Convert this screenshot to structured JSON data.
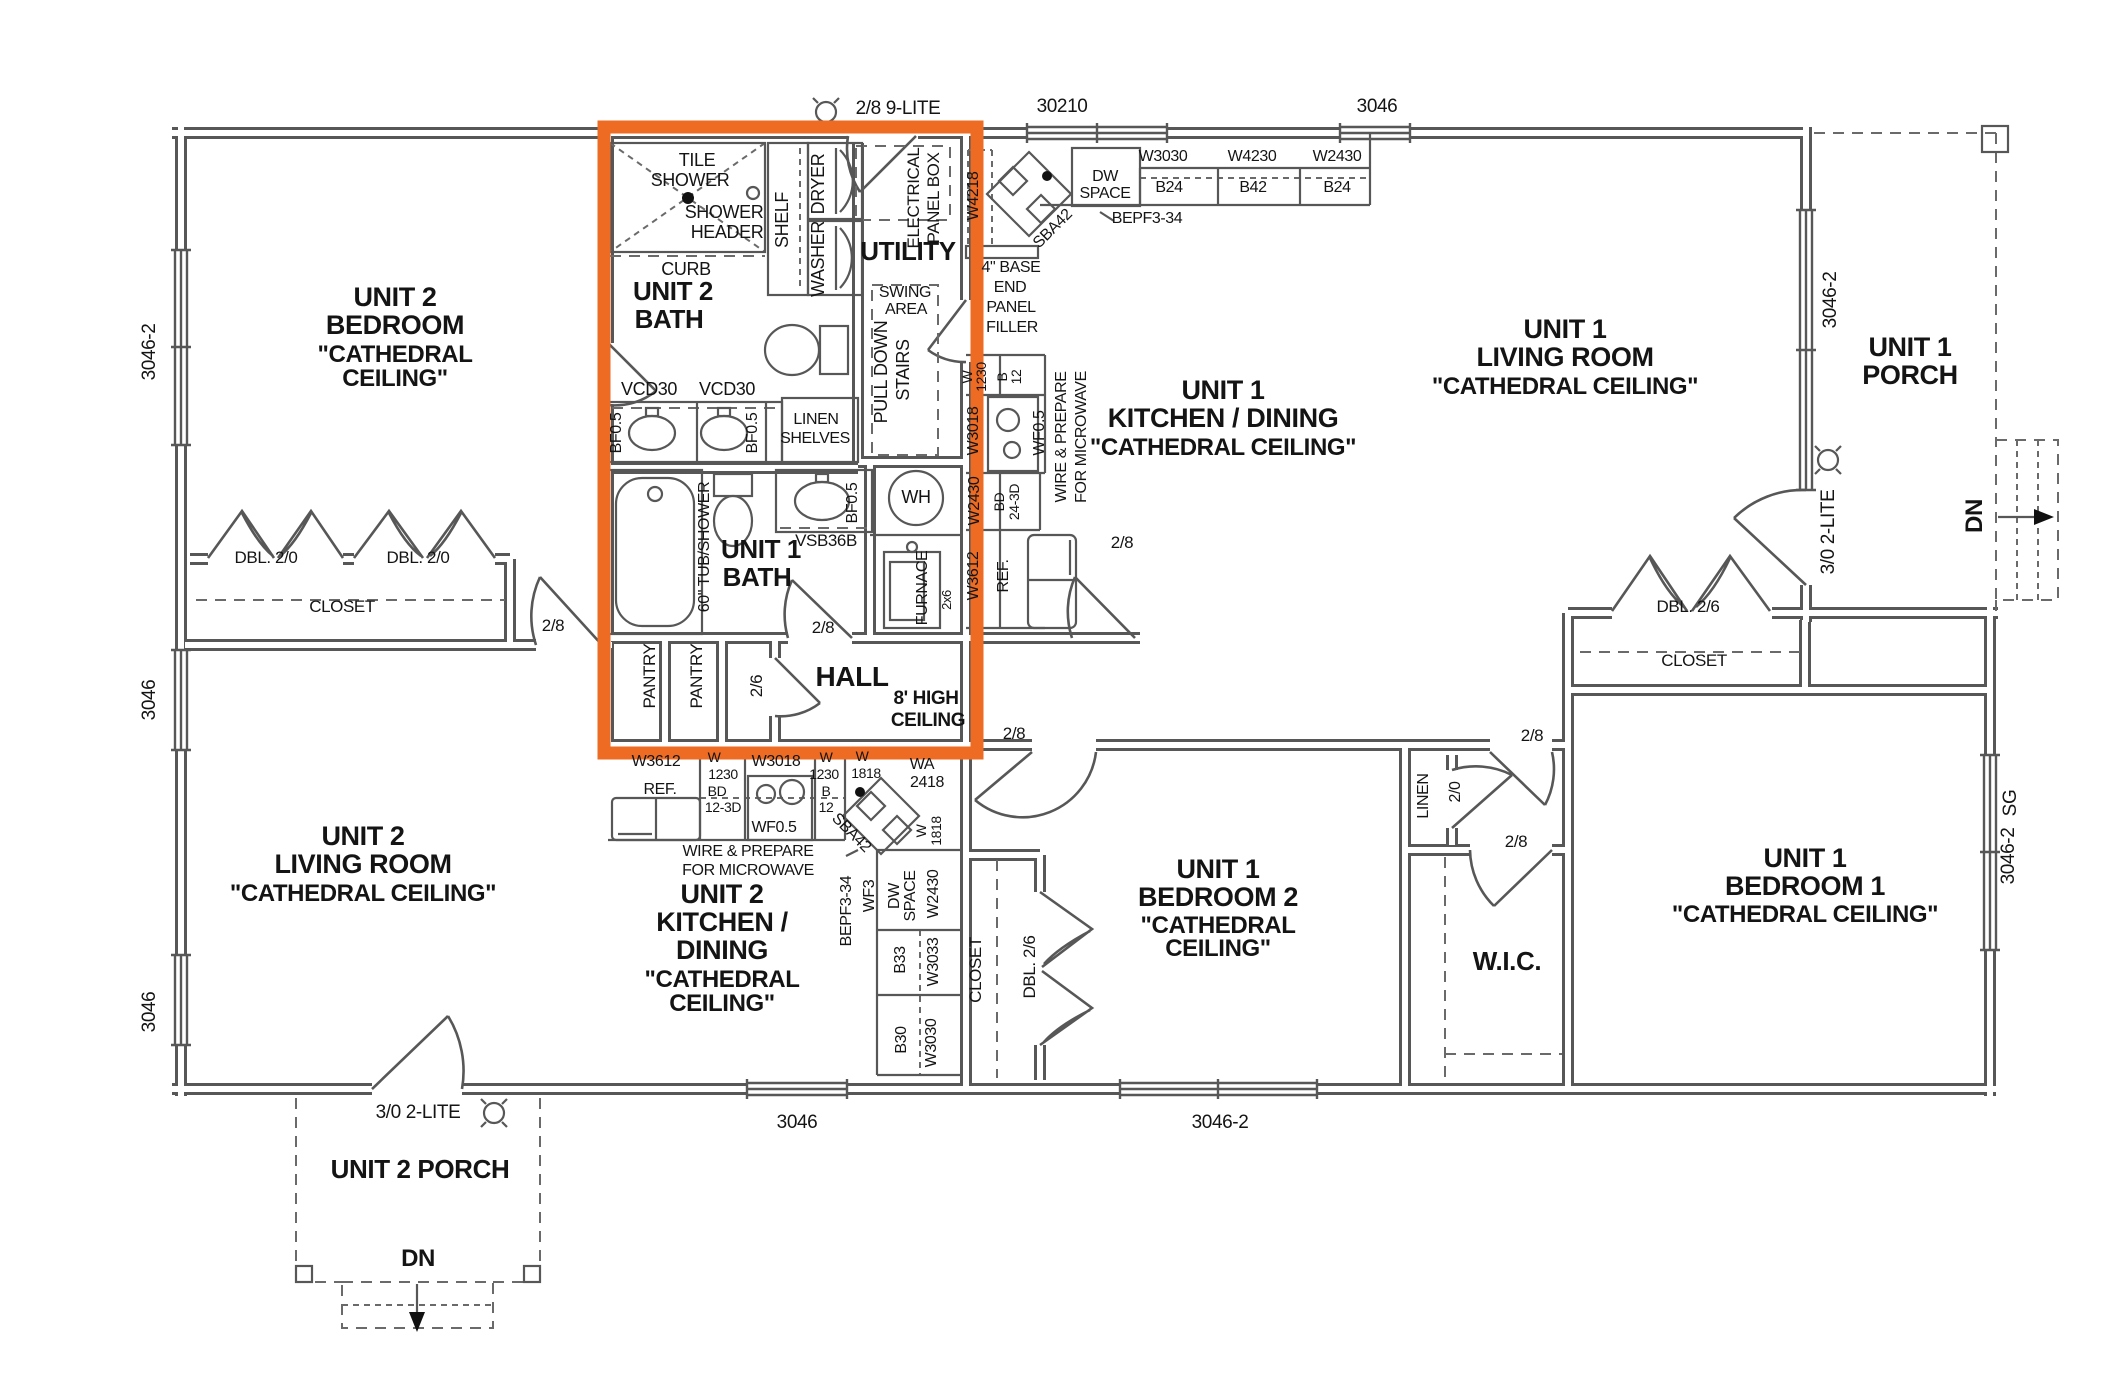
{
  "title": "Duplex floor plan",
  "colors": {
    "highlight_box": "#ee6b23",
    "wall": "#575757",
    "text": "#141414",
    "background": "#ffffff"
  },
  "highlight_region": {
    "label": "baths-utility-hall-core",
    "x": 604,
    "y": 127,
    "width": 373,
    "height": 626
  },
  "labels": [
    {
      "id": "dim-top-door",
      "text": "2/8 9-LITE",
      "x": 898,
      "y": 114,
      "s": 19
    },
    {
      "id": "dim-win-30210",
      "text": "30210",
      "x": 1062,
      "y": 112,
      "s": 19
    },
    {
      "id": "dim-win-top-3046",
      "text": "3046",
      "x": 1377,
      "y": 112,
      "s": 19
    },
    {
      "id": "dim-left-3046-2",
      "text": "3046-2",
      "x": 155,
      "y": 352,
      "s": 19,
      "r": -90
    },
    {
      "id": "dim-left-3046-a",
      "text": "3046",
      "x": 155,
      "y": 700,
      "s": 19,
      "r": -90
    },
    {
      "id": "dim-left-3046-b",
      "text": "3046",
      "x": 155,
      "y": 1012,
      "s": 19,
      "r": -90
    },
    {
      "id": "dim-bottom-3046",
      "text": "3046",
      "x": 797,
      "y": 1128,
      "s": 19
    },
    {
      "id": "dim-bottom-3046-2",
      "text": "3046-2",
      "x": 1220,
      "y": 1128,
      "s": 19
    },
    {
      "id": "dim-door-porch2",
      "text": "3/0 2-LITE",
      "x": 418,
      "y": 1118,
      "s": 19
    },
    {
      "id": "dim-door-porch1",
      "text": "3/0 2-LITE",
      "x": 1834,
      "y": 532,
      "s": 19,
      "r": -90
    },
    {
      "id": "dim-win-lr1",
      "text": "3046-2",
      "x": 1836,
      "y": 300,
      "s": 19,
      "r": -90
    },
    {
      "id": "dim-win-sg",
      "text": "SG",
      "x": 2016,
      "y": 803,
      "s": 19,
      "r": -90
    },
    {
      "id": "dim-win-right",
      "text": "3046-2",
      "x": 2014,
      "y": 856,
      "s": 19,
      "r": -90
    },
    {
      "id": "u2bed-1",
      "text": "UNIT 2",
      "x": 395,
      "y": 306,
      "s": 27,
      "b": 1
    },
    {
      "id": "u2bed-2",
      "text": "BEDROOM",
      "x": 395,
      "y": 334,
      "s": 27,
      "b": 1
    },
    {
      "id": "u2bed-3",
      "text": "\"CATHEDRAL",
      "x": 395,
      "y": 362,
      "s": 24,
      "b": 1
    },
    {
      "id": "u2bed-4",
      "text": "CEILING\"",
      "x": 395,
      "y": 386,
      "s": 24,
      "b": 1
    },
    {
      "id": "u2liv-1",
      "text": "UNIT 2",
      "x": 363,
      "y": 845,
      "s": 27,
      "b": 1
    },
    {
      "id": "u2liv-2",
      "text": "LIVING ROOM",
      "x": 363,
      "y": 873,
      "s": 27,
      "b": 1
    },
    {
      "id": "u2liv-3",
      "text": "\"CATHEDRAL CEILING\"",
      "x": 363,
      "y": 901,
      "s": 24,
      "b": 1
    },
    {
      "id": "u2kit-1",
      "text": "UNIT 2",
      "x": 722,
      "y": 903,
      "s": 27,
      "b": 1
    },
    {
      "id": "u2kit-2",
      "text": "KITCHEN /",
      "x": 722,
      "y": 931,
      "s": 27,
      "b": 1
    },
    {
      "id": "u2kit-3",
      "text": "DINING",
      "x": 722,
      "y": 959,
      "s": 27,
      "b": 1
    },
    {
      "id": "u2kit-4",
      "text": "\"CATHEDRAL",
      "x": 722,
      "y": 987,
      "s": 24,
      "b": 1
    },
    {
      "id": "u2kit-5",
      "text": "CEILING\"",
      "x": 722,
      "y": 1011,
      "s": 24,
      "b": 1
    },
    {
      "id": "u2porch",
      "text": "UNIT 2 PORCH",
      "x": 420,
      "y": 1178,
      "s": 26,
      "b": 1
    },
    {
      "id": "u1kit-1",
      "text": "UNIT 1",
      "x": 1223,
      "y": 399,
      "s": 27,
      "b": 1
    },
    {
      "id": "u1kit-2",
      "text": "KITCHEN / DINING",
      "x": 1223,
      "y": 427,
      "s": 27,
      "b": 1
    },
    {
      "id": "u1kit-3",
      "text": "\"CATHEDRAL CEILING\"",
      "x": 1223,
      "y": 455,
      "s": 24,
      "b": 1
    },
    {
      "id": "u1liv-1",
      "text": "UNIT 1",
      "x": 1565,
      "y": 338,
      "s": 27,
      "b": 1
    },
    {
      "id": "u1liv-2",
      "text": "LIVING ROOM",
      "x": 1565,
      "y": 366,
      "s": 27,
      "b": 1
    },
    {
      "id": "u1liv-3",
      "text": "\"CATHEDRAL CEILING\"",
      "x": 1565,
      "y": 394,
      "s": 24,
      "b": 1
    },
    {
      "id": "u1porch-1",
      "text": "UNIT 1",
      "x": 1910,
      "y": 356,
      "s": 27,
      "b": 1
    },
    {
      "id": "u1porch-2",
      "text": "PORCH",
      "x": 1910,
      "y": 384,
      "s": 27,
      "b": 1
    },
    {
      "id": "u1bed2-1",
      "text": "UNIT 1",
      "x": 1218,
      "y": 878,
      "s": 27,
      "b": 1
    },
    {
      "id": "u1bed2-2",
      "text": "BEDROOM 2",
      "x": 1218,
      "y": 906,
      "s": 27,
      "b": 1
    },
    {
      "id": "u1bed2-3",
      "text": "\"CATHEDRAL",
      "x": 1218,
      "y": 933,
      "s": 24,
      "b": 1
    },
    {
      "id": "u1bed2-4",
      "text": "CEILING\"",
      "x": 1218,
      "y": 956,
      "s": 24,
      "b": 1
    },
    {
      "id": "u1bed1-1",
      "text": "UNIT 1",
      "x": 1805,
      "y": 867,
      "s": 27,
      "b": 1
    },
    {
      "id": "u1bed1-2",
      "text": "BEDROOM 1",
      "x": 1805,
      "y": 895,
      "s": 27,
      "b": 1
    },
    {
      "id": "u1bed1-3",
      "text": "\"CATHEDRAL CEILING\"",
      "x": 1805,
      "y": 922,
      "s": 24,
      "b": 1
    },
    {
      "id": "wic",
      "text": "W.I.C.",
      "x": 1507,
      "y": 970,
      "s": 26,
      "b": 1
    },
    {
      "id": "utility",
      "text": "UTILITY",
      "x": 908,
      "y": 260,
      "s": 26,
      "b": 1
    },
    {
      "id": "u2bath-1",
      "text": "UNIT 2",
      "x": 673,
      "y": 300,
      "s": 26,
      "b": 1
    },
    {
      "id": "u2bath-2",
      "text": "BATH",
      "x": 669,
      "y": 328,
      "s": 26,
      "b": 1
    },
    {
      "id": "u1bath-1",
      "text": "UNIT 1",
      "x": 761,
      "y": 558,
      "s": 26,
      "b": 1
    },
    {
      "id": "u1bath-2",
      "text": "BATH",
      "x": 757,
      "y": 586,
      "s": 26,
      "b": 1
    },
    {
      "id": "hall",
      "text": "HALL",
      "x": 852,
      "y": 686,
      "s": 28,
      "b": 1
    },
    {
      "id": "hc-1",
      "text": "8' HIGH",
      "x": 926,
      "y": 704,
      "s": 19,
      "b": 1
    },
    {
      "id": "hc-2",
      "text": "CEILING",
      "x": 928,
      "y": 726,
      "s": 19,
      "b": 1
    },
    {
      "id": "dn-porch2",
      "text": "DN",
      "x": 418,
      "y": 1266,
      "s": 24,
      "b": 1
    },
    {
      "id": "dn-porch1",
      "text": "DN",
      "x": 1982,
      "y": 516,
      "s": 24,
      "b": 1,
      "r": -90
    },
    {
      "id": "tile-1",
      "text": "TILE",
      "x": 697,
      "y": 166,
      "s": 18
    },
    {
      "id": "tile-2",
      "text": "SHOWER",
      "x": 690,
      "y": 186,
      "s": 18
    },
    {
      "id": "shh-1",
      "text": "SHOWER",
      "x": 724,
      "y": 218,
      "s": 18
    },
    {
      "id": "shh-2",
      "text": "HEADER",
      "x": 727,
      "y": 238,
      "s": 18
    },
    {
      "id": "curb",
      "text": "CURB",
      "x": 686,
      "y": 275,
      "s": 18
    },
    {
      "id": "shelf",
      "text": "SHELF",
      "x": 788,
      "y": 220,
      "s": 18,
      "r": -90
    },
    {
      "id": "dryer",
      "text": "DRYER",
      "x": 824,
      "y": 184,
      "s": 18,
      "r": -90
    },
    {
      "id": "washer",
      "text": "WASHER",
      "x": 824,
      "y": 259,
      "s": 18,
      "r": -90
    },
    {
      "id": "elec-1",
      "text": "ELECTRICAL",
      "x": 919,
      "y": 198,
      "s": 17,
      "r": -90
    },
    {
      "id": "elec-2",
      "text": "PANEL BOX",
      "x": 939,
      "y": 198,
      "s": 17,
      "r": -90
    },
    {
      "id": "swing-1",
      "text": "SWING",
      "x": 905,
      "y": 297,
      "s": 16
    },
    {
      "id": "swing-2",
      "text": "AREA",
      "x": 906,
      "y": 314,
      "s": 16
    },
    {
      "id": "pulldown-1",
      "text": "PULL DOWN",
      "x": 887,
      "y": 372,
      "s": 18,
      "r": -90
    },
    {
      "id": "pulldown-2",
      "text": "STAIRS",
      "x": 909,
      "y": 370,
      "s": 18,
      "r": -90
    },
    {
      "id": "vcd30-1",
      "text": "VCD30",
      "x": 649,
      "y": 395,
      "s": 18
    },
    {
      "id": "vcd30-2",
      "text": "VCD30",
      "x": 727,
      "y": 395,
      "s": 18
    },
    {
      "id": "bf05-1",
      "text": "BF0.5",
      "x": 621,
      "y": 433,
      "s": 16,
      "r": -90
    },
    {
      "id": "bf05-2",
      "text": "BF0.5",
      "x": 757,
      "y": 433,
      "s": 16,
      "r": -90
    },
    {
      "id": "bf05-3",
      "text": "BF0.5",
      "x": 857,
      "y": 503,
      "s": 16,
      "r": -90
    },
    {
      "id": "linsh-1",
      "text": "LINEN",
      "x": 816,
      "y": 424,
      "s": 16
    },
    {
      "id": "linsh-2",
      "text": "SHELVES",
      "x": 815,
      "y": 443,
      "s": 16
    },
    {
      "id": "wh",
      "text": "WH",
      "x": 916,
      "y": 503,
      "s": 18
    },
    {
      "id": "furnace",
      "text": "FURNACE",
      "x": 927,
      "y": 588,
      "s": 16,
      "r": -90
    },
    {
      "id": "wall2x6",
      "text": "2x6",
      "x": 951,
      "y": 600,
      "s": 13,
      "r": -90
    },
    {
      "id": "tub",
      "text": "60\" TUB/SHOWER",
      "x": 709,
      "y": 547,
      "s": 16,
      "r": -90
    },
    {
      "id": "vsb36b",
      "text": "VSB36B",
      "x": 826,
      "y": 546,
      "s": 17
    },
    {
      "id": "pantry-1",
      "text": "PANTRY",
      "x": 655,
      "y": 676,
      "s": 17,
      "r": -90
    },
    {
      "id": "pantry-2",
      "text": "PANTRY",
      "x": 702,
      "y": 676,
      "s": 17,
      "r": -90
    },
    {
      "id": "door26",
      "text": "2/6",
      "x": 762,
      "y": 686,
      "s": 17,
      "r": -90
    },
    {
      "id": "door28-a",
      "text": "2/8",
      "x": 823,
      "y": 633,
      "s": 17
    },
    {
      "id": "door28-b",
      "text": "2/8",
      "x": 553,
      "y": 631,
      "s": 17
    },
    {
      "id": "door28-c",
      "text": "2/8",
      "x": 1014,
      "y": 739,
      "s": 17
    },
    {
      "id": "door28-d",
      "text": "2/8",
      "x": 1122,
      "y": 548,
      "s": 17
    },
    {
      "id": "door28-e",
      "text": "2/8",
      "x": 1532,
      "y": 741,
      "s": 17
    },
    {
      "id": "door28-f",
      "text": "2/8",
      "x": 1516,
      "y": 847,
      "s": 17
    },
    {
      "id": "linen",
      "text": "LINEN",
      "x": 1428,
      "y": 796,
      "s": 16,
      "r": -90
    },
    {
      "id": "door20",
      "text": "2/0",
      "x": 1460,
      "y": 792,
      "s": 16,
      "r": -90
    },
    {
      "id": "closet-u2bed",
      "text": "CLOSET",
      "x": 342,
      "y": 612,
      "s": 17
    },
    {
      "id": "dbl20-1",
      "text": "DBL. 2/0",
      "x": 266,
      "y": 563,
      "s": 17
    },
    {
      "id": "dbl20-2",
      "text": "DBL. 2/0",
      "x": 418,
      "y": 563,
      "s": 17
    },
    {
      "id": "closet-u1liv",
      "text": "CLOSET",
      "x": 1694,
      "y": 666,
      "s": 17
    },
    {
      "id": "dbl26-1",
      "text": "DBL. 2/6",
      "x": 1688,
      "y": 612,
      "s": 17
    },
    {
      "id": "closet-bed2",
      "text": "CLOSET",
      "x": 981,
      "y": 970,
      "s": 17,
      "r": -90
    },
    {
      "id": "dbl26-2",
      "text": "DBL. 2/6",
      "x": 1035,
      "y": 967,
      "s": 17,
      "r": -90
    },
    {
      "id": "k1-w4218",
      "text": "W4218",
      "x": 978,
      "y": 196,
      "s": 16,
      "r": -90
    },
    {
      "id": "k1-sba42",
      "text": "SBA42",
      "x": 1056,
      "y": 232,
      "s": 16,
      "r": -45
    },
    {
      "id": "k1-dw",
      "text": "DW",
      "x": 1105,
      "y": 181,
      "s": 16
    },
    {
      "id": "k1-space",
      "text": "SPACE",
      "x": 1105,
      "y": 198,
      "s": 16
    },
    {
      "id": "k1-bepf",
      "text": "BEPF3-34",
      "x": 1147,
      "y": 223,
      "s": 16
    },
    {
      "id": "k1-w3030",
      "text": "W3030",
      "x": 1163,
      "y": 161,
      "s": 16
    },
    {
      "id": "k1-w4230",
      "text": "W4230",
      "x": 1252,
      "y": 161,
      "s": 16
    },
    {
      "id": "k1-w2430",
      "text": "W2430",
      "x": 1337,
      "y": 161,
      "s": 16
    },
    {
      "id": "k1-b24a",
      "text": "B24",
      "x": 1169,
      "y": 192,
      "s": 16
    },
    {
      "id": "k1-b42",
      "text": "B42",
      "x": 1253,
      "y": 192,
      "s": 16
    },
    {
      "id": "k1-b24b",
      "text": "B24",
      "x": 1337,
      "y": 192,
      "s": 16
    },
    {
      "id": "k1-filler-1",
      "text": "4\" BASE",
      "x": 1011,
      "y": 272,
      "s": 16
    },
    {
      "id": "k1-filler-2",
      "text": "END",
      "x": 1010,
      "y": 292,
      "s": 16
    },
    {
      "id": "k1-filler-3",
      "text": "PANEL",
      "x": 1011,
      "y": 312,
      "s": 16
    },
    {
      "id": "k1-filler-4",
      "text": "FILLER",
      "x": 1012,
      "y": 332,
      "s": 16
    },
    {
      "id": "k1-w-a",
      "text": "W",
      "x": 972,
      "y": 377,
      "s": 14,
      "r": -90
    },
    {
      "id": "k1-1230",
      "text": "1230",
      "x": 986,
      "y": 377,
      "s": 14,
      "r": -90
    },
    {
      "id": "k1-b",
      "text": "B",
      "x": 1007,
      "y": 377,
      "s": 14,
      "r": -90
    },
    {
      "id": "k1-12",
      "text": "12",
      "x": 1021,
      "y": 377,
      "s": 14,
      "r": -90
    },
    {
      "id": "k1-w3018",
      "text": "W3018",
      "x": 978,
      "y": 431,
      "s": 16,
      "r": -90
    },
    {
      "id": "k1-wf05",
      "text": "WF0.5",
      "x": 1044,
      "y": 433,
      "s": 16,
      "r": -90
    },
    {
      "id": "k1-wire-1",
      "text": "WIRE & PREPARE",
      "x": 1066,
      "y": 437,
      "s": 16,
      "r": -90
    },
    {
      "id": "k1-wire-2",
      "text": "FOR MICROWAVE",
      "x": 1086,
      "y": 437,
      "s": 16,
      "r": -90
    },
    {
      "id": "k1-w2430b",
      "text": "W2430",
      "x": 979,
      "y": 501,
      "s": 16,
      "r": -90
    },
    {
      "id": "k1-bd",
      "text": "BD",
      "x": 1004,
      "y": 502,
      "s": 14,
      "r": -90
    },
    {
      "id": "k1-243d",
      "text": "24-3D",
      "x": 1019,
      "y": 502,
      "s": 14,
      "r": -90
    },
    {
      "id": "k1-w3612",
      "text": "W3612",
      "x": 978,
      "y": 576,
      "s": 16,
      "r": -90
    },
    {
      "id": "k1-ref",
      "text": "REF.",
      "x": 1008,
      "y": 576,
      "s": 16,
      "r": -90
    },
    {
      "id": "k2-w3612",
      "text": "W3612",
      "x": 656,
      "y": 766,
      "s": 16
    },
    {
      "id": "k2-ref",
      "text": "REF.",
      "x": 660,
      "y": 794,
      "s": 16
    },
    {
      "id": "k2-w-a",
      "text": "W",
      "x": 714,
      "y": 762,
      "s": 14
    },
    {
      "id": "k2-1230a",
      "text": "1230",
      "x": 723,
      "y": 779,
      "s": 14
    },
    {
      "id": "k2-bd",
      "text": "BD",
      "x": 717,
      "y": 796,
      "s": 14
    },
    {
      "id": "k2-123d",
      "text": "12-3D",
      "x": 723,
      "y": 812,
      "s": 14
    },
    {
      "id": "k2-w3018",
      "text": "W3018",
      "x": 776,
      "y": 766,
      "s": 16
    },
    {
      "id": "k2-wf05",
      "text": "WF0.5",
      "x": 774,
      "y": 832,
      "s": 16
    },
    {
      "id": "k2-w-b",
      "text": "W",
      "x": 826,
      "y": 762,
      "s": 14
    },
    {
      "id": "k2-1230b",
      "text": "1230",
      "x": 824,
      "y": 779,
      "s": 14
    },
    {
      "id": "k2-b",
      "text": "B",
      "x": 826,
      "y": 796,
      "s": 14
    },
    {
      "id": "k2-12",
      "text": "12",
      "x": 826,
      "y": 812,
      "s": 14
    },
    {
      "id": "k2-w-c",
      "text": "W",
      "x": 862,
      "y": 761,
      "s": 14
    },
    {
      "id": "k2-1818a",
      "text": "1818",
      "x": 866,
      "y": 778,
      "s": 14
    },
    {
      "id": "k2-wa",
      "text": "WA",
      "x": 922,
      "y": 769,
      "s": 16
    },
    {
      "id": "k2-2418",
      "text": "2418",
      "x": 927,
      "y": 787,
      "s": 16
    },
    {
      "id": "k2-sba42",
      "text": "SBA42",
      "x": 848,
      "y": 836,
      "s": 16,
      "r": 45
    },
    {
      "id": "k2-w-d",
      "text": "W",
      "x": 926,
      "y": 831,
      "s": 14,
      "r": -90
    },
    {
      "id": "k2-1818b",
      "text": "1818",
      "x": 941,
      "y": 831,
      "s": 14,
      "r": -90
    },
    {
      "id": "k2-bepf",
      "text": "BEPF3-34",
      "x": 851,
      "y": 911,
      "s": 16,
      "r": -90
    },
    {
      "id": "k2-wf3",
      "text": "WF3",
      "x": 874,
      "y": 896,
      "s": 16,
      "r": -90
    },
    {
      "id": "k2-dw",
      "text": "DW",
      "x": 899,
      "y": 896,
      "s": 16,
      "r": -90
    },
    {
      "id": "k2-space",
      "text": "SPACE",
      "x": 915,
      "y": 896,
      "s": 16,
      "r": -90
    },
    {
      "id": "k2-w2430",
      "text": "W2430",
      "x": 938,
      "y": 894,
      "s": 16,
      "r": -90
    },
    {
      "id": "k2-b33",
      "text": "B33",
      "x": 905,
      "y": 960,
      "s": 16,
      "r": -90
    },
    {
      "id": "k2-w3033",
      "text": "W3033",
      "x": 938,
      "y": 962,
      "s": 16,
      "r": -90
    },
    {
      "id": "k2-b30",
      "text": "B30",
      "x": 906,
      "y": 1040,
      "s": 16,
      "r": -90
    },
    {
      "id": "k2-w3030",
      "text": "W3030",
      "x": 936,
      "y": 1043,
      "s": 16,
      "r": -90
    },
    {
      "id": "k2-wire-1",
      "text": "WIRE & PREPARE",
      "x": 748,
      "y": 856,
      "s": 16
    },
    {
      "id": "k2-wire-2",
      "text": "FOR MICROWAVE",
      "x": 748,
      "y": 875,
      "s": 16
    }
  ]
}
